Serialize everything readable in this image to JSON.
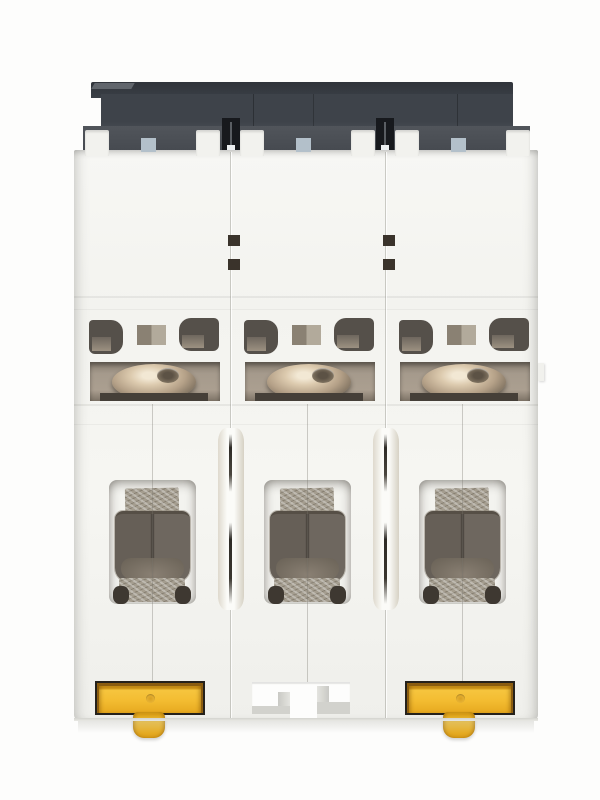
{
  "device": {
    "name": "3-pole DIN-rail miniature circuit breaker",
    "view": "rear (DIN-rail mounting side) product photo on white background",
    "pole_count": 3,
    "poles": [
      {
        "label": "pole-1",
        "din_clip": "yellow slide clip present",
        "terminal_screw": "metallic dome head",
        "clamp": "dark box terminal"
      },
      {
        "label": "pole-2",
        "din_clip": "rail notch exposed, clip not visible",
        "terminal_screw": "metallic dome head",
        "clamp": "dark box terminal"
      },
      {
        "label": "pole-3",
        "din_clip": "yellow slide clip present",
        "terminal_screw": "metallic dome head",
        "clamp": "dark box terminal"
      }
    ],
    "features": [
      "dark charcoal top housing cap",
      "white molded housing modules with seams",
      "ventilation openings per pole",
      "recessed terminal screw windows",
      "box terminal clamps with metal contact plates",
      "yellow DIN-rail slide clips",
      "central DIN-rail notch cutout"
    ]
  },
  "palette": {
    "page-bg": "#fdfdfc",
    "cap-top": "#30343a",
    "cap-front": "#3e434a",
    "cap-band": "#51555b",
    "slot-dark": "#17191d",
    "tab-white": "#f2f2ee",
    "blue-mark": "#b3c0ca",
    "vent-dark": "#55504a",
    "vent-tan": "#9c9181",
    "vent-sq-l": "#8a8173",
    "vent-sq-r": "#b2aa9b",
    "screw-bg": "#a59a8c",
    "metal-hi": "#f2e8d4",
    "metal-mid": "#b5a188",
    "metal-dark": "#564c41",
    "metal-plate": "#a49d8f",
    "clamp-l": "#665f57",
    "clamp-r": "#6e675f",
    "clamp-gap": "#49433d",
    "clamp-floor": "#8d8376",
    "recess-bg": "#f3f3ef",
    "groove-wall": "#ded9cd",
    "groove-line": "#2e2b26",
    "clip-outline": "#25211b",
    "clip-amber": "#f6c53e",
    "clip-amber-dk": "#e7a91f",
    "clip-orange": "#8a5c10",
    "notch-wall": "#d2d2cd"
  }
}
